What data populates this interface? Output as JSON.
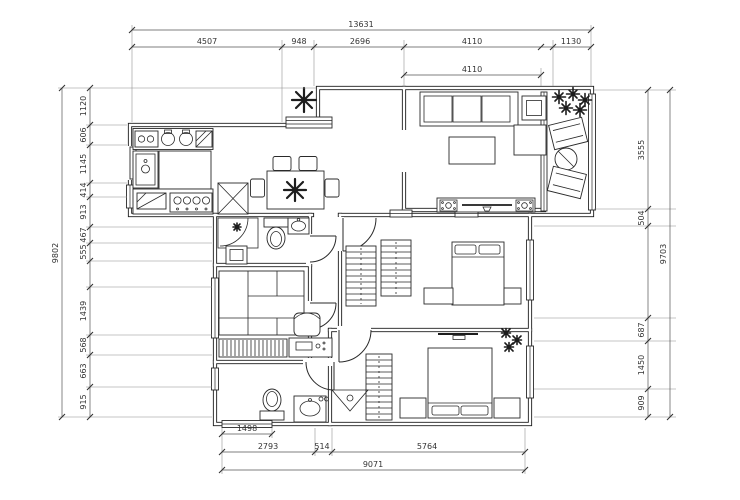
{
  "colors": {
    "wall": "#1b1b1b",
    "furniture": "#2a2a2a",
    "dimension_text": "#333333",
    "background": "#ffffff"
  },
  "icons": {
    "plant": "asterisk-burst",
    "refrigerator": "box-with-x-cross",
    "stove": "rect-with-four-burner-circles",
    "sink": "rect-with-oval-and-faucet",
    "toilet": "tank-rect-with-bowl-ellipse",
    "shower": "corner-rect-with-quarter-arc",
    "wardrobe": "rect-with-hanging-stripes",
    "window": "double-parallel-lines",
    "door": "leaf-line-with-quarter-arc"
  },
  "dims": {
    "top": {
      "overall": "13631",
      "segs": [
        "4507",
        "948",
        "2696",
        "4110",
        "1130"
      ],
      "living_width": "4110"
    },
    "left": {
      "overall": "9802",
      "segs": [
        "1120",
        "606",
        "1145",
        "414",
        "913",
        "467",
        "555",
        "1439",
        "568",
        "663",
        "915"
      ]
    },
    "right": {
      "overall": "9703",
      "segs": [
        "3555",
        "504",
        "687",
        "1450",
        "909"
      ]
    },
    "bottom": {
      "overall": "9071",
      "segs": [
        "2793",
        "514",
        "5764"
      ],
      "bath_window": "1498"
    }
  }
}
